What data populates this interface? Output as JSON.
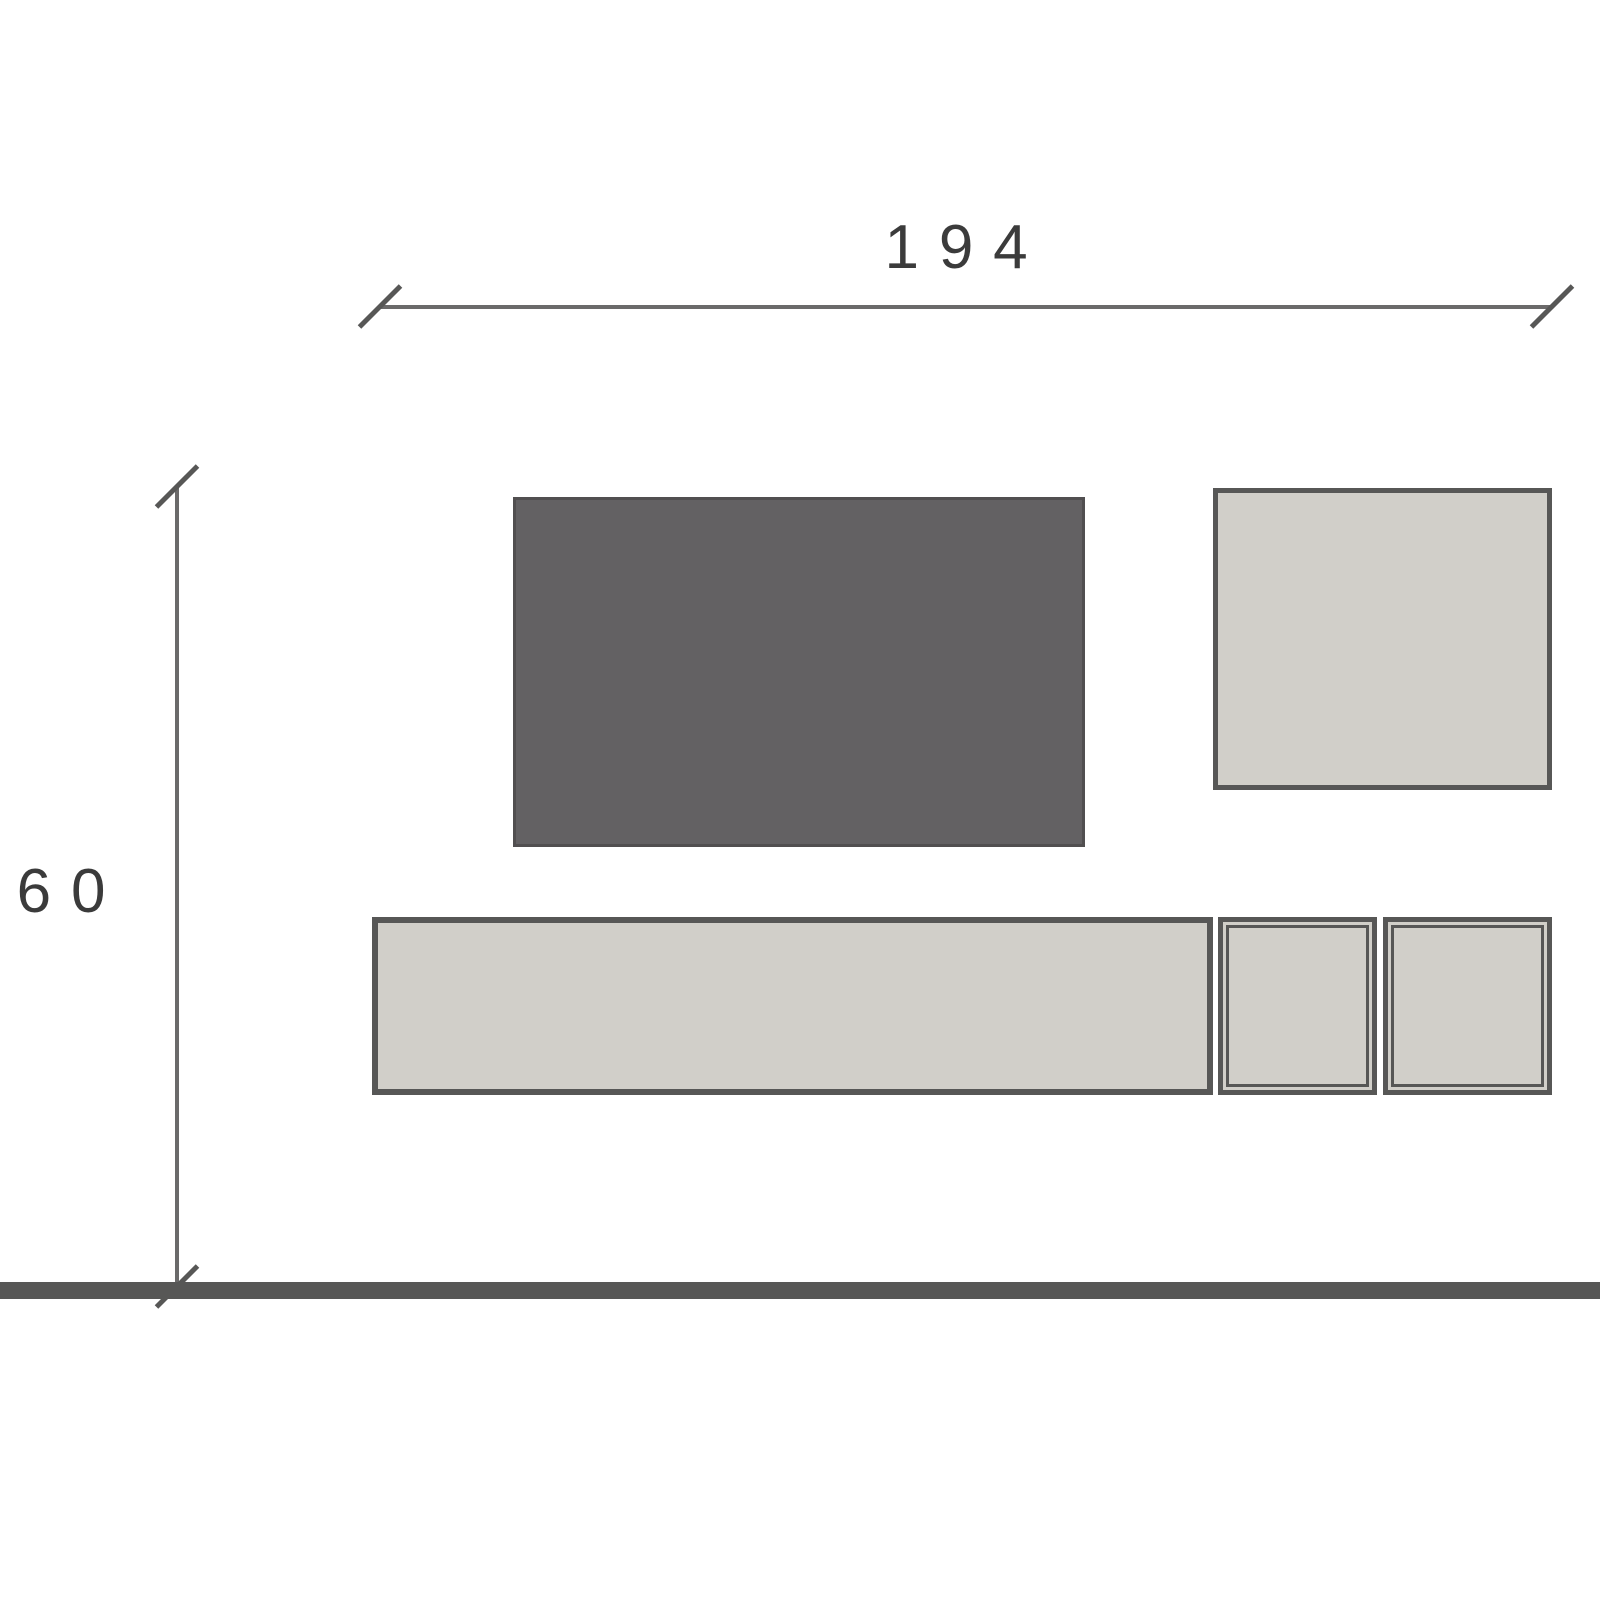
{
  "diagram": {
    "type": "furniture-elevation-drawing",
    "width_dimension": {
      "label": "194"
    },
    "height_dimension": {
      "label": "60"
    },
    "colors": {
      "background": "#ffffff",
      "dark_panel_fill": "#636163",
      "light_panel_fill": "#d1cfc9",
      "outline": "#575756",
      "dimension_line": "#6b6a6a",
      "floor_line": "#575756",
      "label_text": "#3b3b3b"
    },
    "elements": [
      {
        "name": "horizontal-dimension",
        "value": "194"
      },
      {
        "name": "vertical-dimension",
        "value": "60"
      },
      {
        "name": "dark-wall-panel"
      },
      {
        "name": "wall-cabinet"
      },
      {
        "name": "long-base-unit"
      },
      {
        "name": "cube-unit-1"
      },
      {
        "name": "cube-unit-2"
      },
      {
        "name": "floor-line"
      }
    ]
  }
}
